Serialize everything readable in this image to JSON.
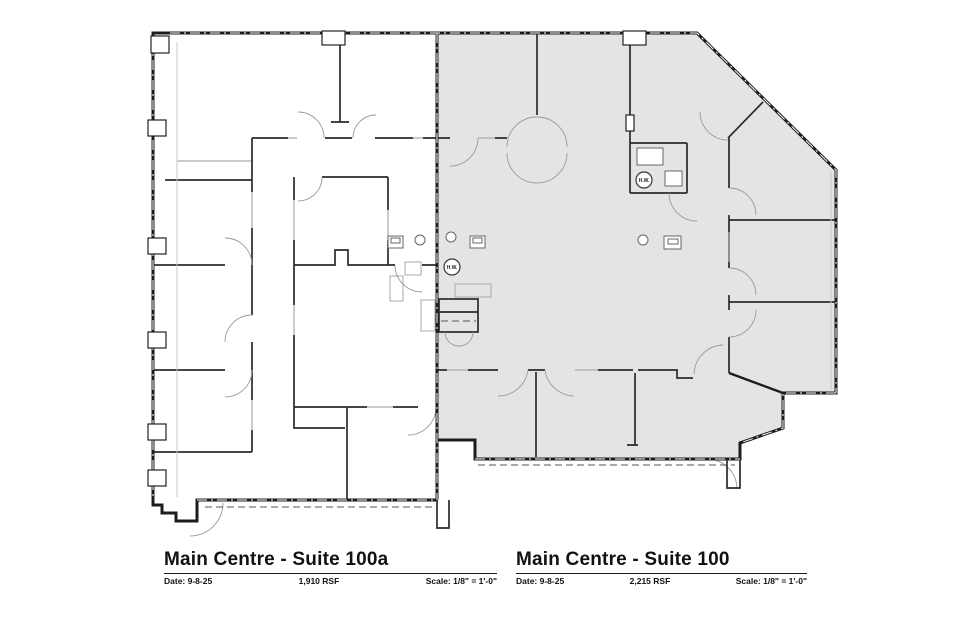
{
  "plan": {
    "type": "architectural-floor-plan",
    "hw_labels": [
      {
        "text": "H.W."
      },
      {
        "text": "H.W."
      }
    ]
  },
  "titleblocks": [
    {
      "title": "Main Centre - Suite 100a",
      "date": "Date: 9-8-25",
      "rsf": "1,910 RSF",
      "scale": "Scale: 1/8\" = 1'-0\""
    },
    {
      "title": "Main Centre - Suite 100",
      "date": "Date: 9-8-25",
      "rsf": "2,215 RSF",
      "scale": "Scale: 1/8\" = 1'-0\""
    }
  ],
  "colors": {
    "background": "#ffffff",
    "suite_100_fill": "#e4e4e4",
    "wall": "#1c1c1c",
    "door_arc": "#9a9a9a",
    "sill": "#ababab"
  }
}
